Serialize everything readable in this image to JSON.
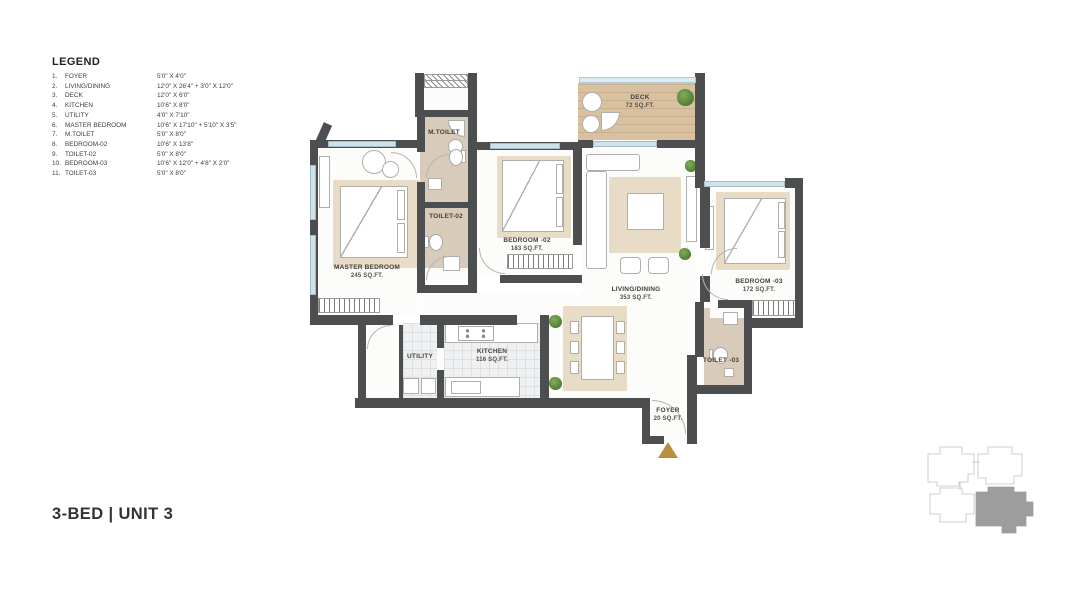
{
  "legend": {
    "title": "LEGEND",
    "items": [
      {
        "num": "1.",
        "name": "FOYER",
        "dims": "5'0\" X 4'0\""
      },
      {
        "num": "2.",
        "name": "LIVING/DINING",
        "dims": "12'0\" X 26'4\" + 3'0\" X 12'0\""
      },
      {
        "num": "3.",
        "name": "DECK",
        "dims": "12'0\" X 6'0\""
      },
      {
        "num": "4.",
        "name": "KITCHEN",
        "dims": "10'6\" X 8'0\""
      },
      {
        "num": "5.",
        "name": "UTILITY",
        "dims": "4'0\" X 7'10\""
      },
      {
        "num": "6.",
        "name": "MASTER BEDROOM",
        "dims": "10'6\" X 17'10\" + 5'10\" X 3'5\""
      },
      {
        "num": "7.",
        "name": "M.TOILET",
        "dims": "5'0\" X 8'0\""
      },
      {
        "num": "8.",
        "name": "BEDROOM-02",
        "dims": "10'6\" X 13'8\""
      },
      {
        "num": "9.",
        "name": "TOILET-02",
        "dims": "5'0\" X 8'0\""
      },
      {
        "num": "10.",
        "name": "BEDROOM-03",
        "dims": "10'6\" X 12'0\" + 4'8\" X 2'0\""
      },
      {
        "num": "11.",
        "name": "TOILET-03",
        "dims": "5'0\" X 8'0\""
      }
    ]
  },
  "unit_title": "3-BED | UNIT 3",
  "rooms": {
    "master_bedroom": {
      "name": "MASTER BEDROOM",
      "area": "245 SQ.FT."
    },
    "m_toilet": {
      "name": "M.TOILET"
    },
    "toilet_02": {
      "name": "TOILET-02"
    },
    "bedroom_02": {
      "name": "BEDROOM -02",
      "area": "183 SQ.FT."
    },
    "deck": {
      "name": "DECK",
      "area": "72 SQ.FT."
    },
    "living_dining": {
      "name": "LIVING/DINING",
      "area": "353 SQ.FT."
    },
    "bedroom_03": {
      "name": "BEDROOM -03",
      "area": "172 SQ.FT."
    },
    "toilet_03": {
      "name": "TOILET -03"
    },
    "kitchen": {
      "name": "KITCHEN",
      "area": "116 SQ.FT."
    },
    "utility": {
      "name": "UTILITY"
    },
    "foyer": {
      "name": "FOYER",
      "area": "20 SQ.FT."
    }
  },
  "colors": {
    "wall": "#4d4e50",
    "window": "#cfe2ea",
    "deck_wood": "#d8c1a1",
    "toilet_floor": "#d9cbb9",
    "rug": "#e9dcc6",
    "tile": "#eef0f1",
    "plant": "#5c8f3f",
    "entry_arrow": "#b8903f",
    "keyplan_highlight": "#9d9d9d"
  }
}
